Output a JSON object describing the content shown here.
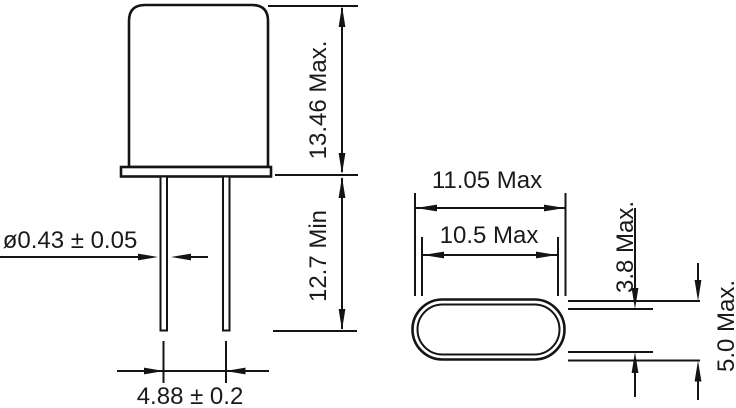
{
  "drawing": {
    "side_view": {
      "body_height": "13.46 Max.",
      "lead_length": "12.7 Min",
      "lead_diameter": "ø0.43 ± 0.05",
      "lead_spacing": "4.88 ± 0.2"
    },
    "top_view": {
      "outer_width": "11.05 Max",
      "inner_width": "10.5 Max",
      "inner_thickness": "3.8 Max.",
      "outer_thickness": "5.0 Max."
    },
    "colors": {
      "line": "#141414",
      "text": "#1a1a1a",
      "background": "#ffffff"
    }
  }
}
